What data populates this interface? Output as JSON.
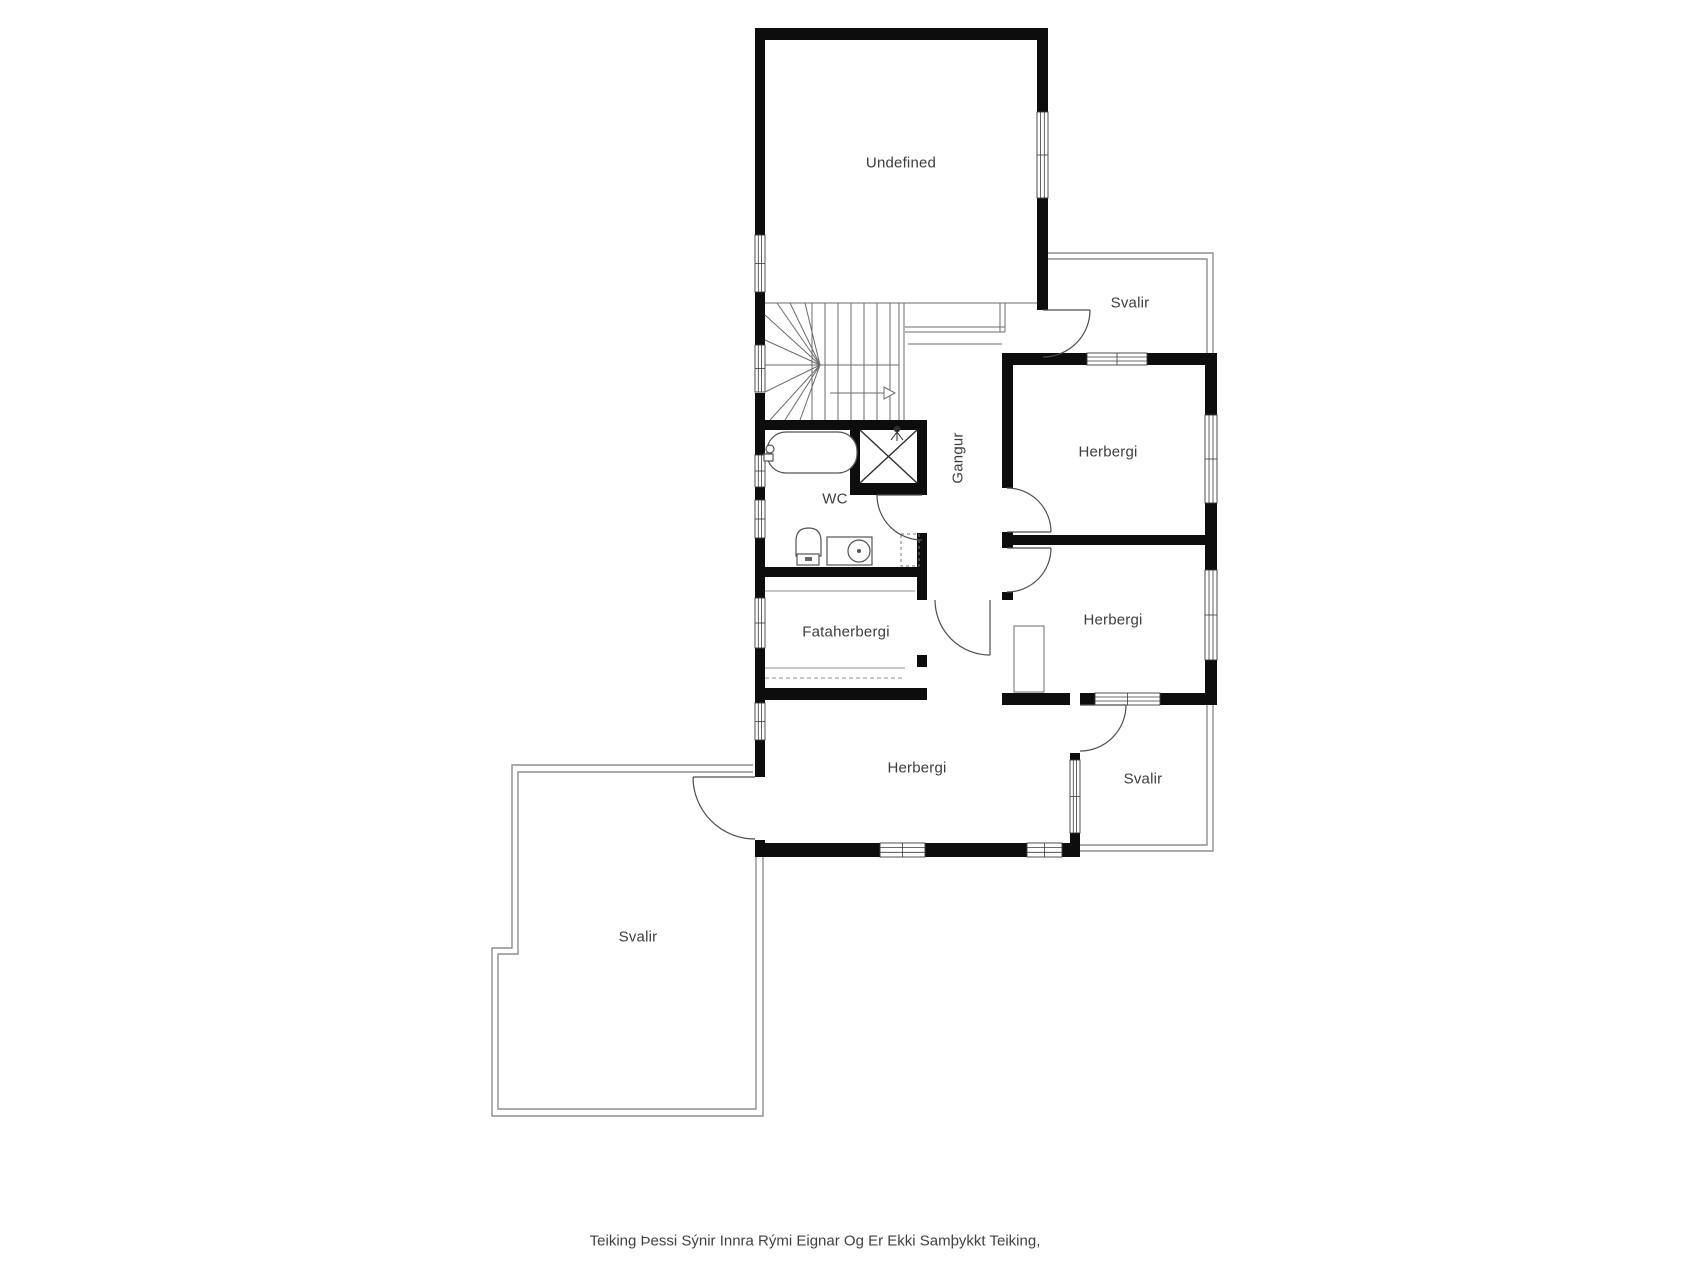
{
  "rooms": {
    "undefined_room": {
      "label": "Undefined"
    },
    "svalir_top_right": {
      "label": "Svalir"
    },
    "herbergi_top_right": {
      "label": "Herbergi"
    },
    "gangur": {
      "label": "Gangur"
    },
    "wc": {
      "label": "WC"
    },
    "herbergi_mid_right": {
      "label": "Herbergi"
    },
    "fataherbergi": {
      "label": "Fataherbergi"
    },
    "herbergi_bottom": {
      "label": "Herbergi"
    },
    "svalir_bottom_right": {
      "label": "Svalir"
    },
    "svalir_bottom_left": {
      "label": "Svalir"
    }
  },
  "caption": {
    "text": "Teiking Þessi Sýnir Innra Rými Eignar Og Er Ekki Samþykkt Teiking,"
  },
  "colors": {
    "wall": "#0d0d0d",
    "thin_wall": "#8f8f8f",
    "stair_line": "#6b6b6b",
    "door_line": "#4d4d4d",
    "fixture_line": "#555555",
    "text": "#3d3d3d",
    "background": "#ffffff"
  }
}
